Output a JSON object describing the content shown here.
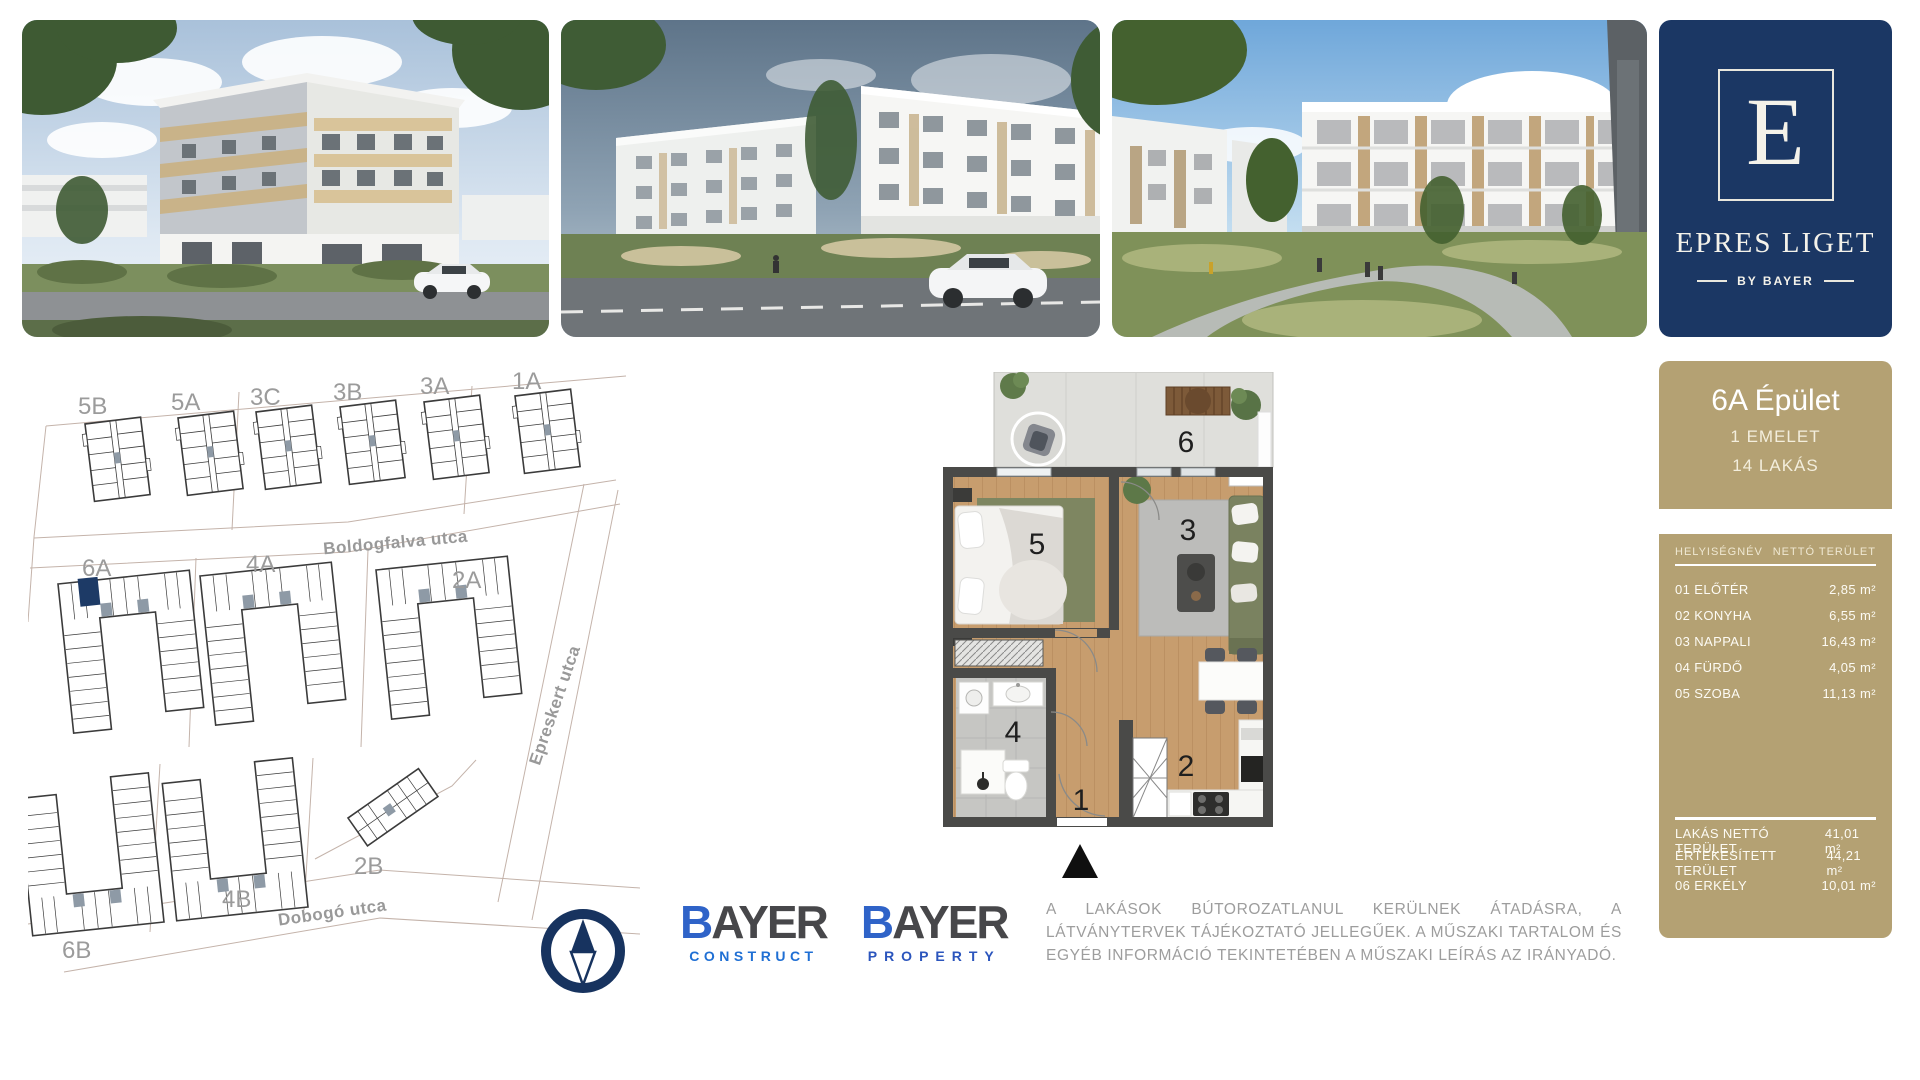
{
  "photos": [
    {
      "label": "street-corner-render"
    },
    {
      "label": "street-view-render"
    },
    {
      "label": "courtyard-render"
    }
  ],
  "brand": {
    "monogram": "E",
    "name": "EPRES LIGET",
    "byline": "BY BAYER"
  },
  "site_map": {
    "streets": {
      "boldogfalva": "Boldogfalva utca",
      "epreskert": "Epreskert utca",
      "dobogo": "Dobogó utca"
    },
    "buildings": {
      "b5B": "5B",
      "b5A": "5A",
      "b3C": "3C",
      "b3B": "3B",
      "b3A": "3A",
      "b1A": "1A",
      "b6A": "6A",
      "b4A": "4A",
      "b2A": "2A",
      "b2B": "2B",
      "b4B": "4B",
      "b6B": "6B"
    },
    "highlighted": "6A"
  },
  "floor_plan": {
    "rooms": {
      "n1": "1",
      "n2": "2",
      "n3": "3",
      "n4": "4",
      "n5": "5",
      "n6": "6"
    }
  },
  "panel": {
    "title": "6A Épület",
    "subtitle1": "1 EMELET",
    "subtitle2": "14 LAKÁS",
    "col_name": "HELYISÉGNÉV",
    "col_area": "NETTÓ TERÜLET",
    "rows": [
      {
        "name": "01 ELŐTÉR",
        "area": "2,85 m²"
      },
      {
        "name": "02 KONYHA",
        "area": "6,55 m²"
      },
      {
        "name": "03 NAPPALI",
        "area": "16,43 m²"
      },
      {
        "name": "04 FÜRDŐ",
        "area": "4,05 m²"
      },
      {
        "name": "05 SZOBA",
        "area": "11,13 m²"
      }
    ],
    "summary": [
      {
        "name": "LAKÁS NETTÓ TERÜLET",
        "area": "41,01 m²"
      },
      {
        "name": "ÉRTÉKESÍTETT TERÜLET",
        "area": "44,21 m²"
      },
      {
        "name": "06 ERKÉLY",
        "area": "10,01 m²"
      }
    ]
  },
  "footer": {
    "logo1": {
      "brand_b": "B",
      "brand_rest": "AYER",
      "division": "CONSTRUCT"
    },
    "logo2": {
      "brand_b": "B",
      "brand_rest": "AYER",
      "division": "PROPERTY"
    },
    "disclaimer": "A LAKÁSOK BÚTOROZATLANUL KERÜLNEK ÁTADÁSRA, A LÁTVÁNYTERVEK TÁJÉKOZTATÓ JELLEGŰEK. A MŰSZAKI TARTALOM ÉS EGYÉB INFORMÁCIÓ TEKINTETÉBEN A MŰSZAKI LEÍRÁS AZ IRÁNYADÓ."
  },
  "colors": {
    "navy": "#1b3764",
    "tan": "#b4a173",
    "bayer_blue": "#2a5fc6",
    "label_gray": "#9b9b9b"
  }
}
